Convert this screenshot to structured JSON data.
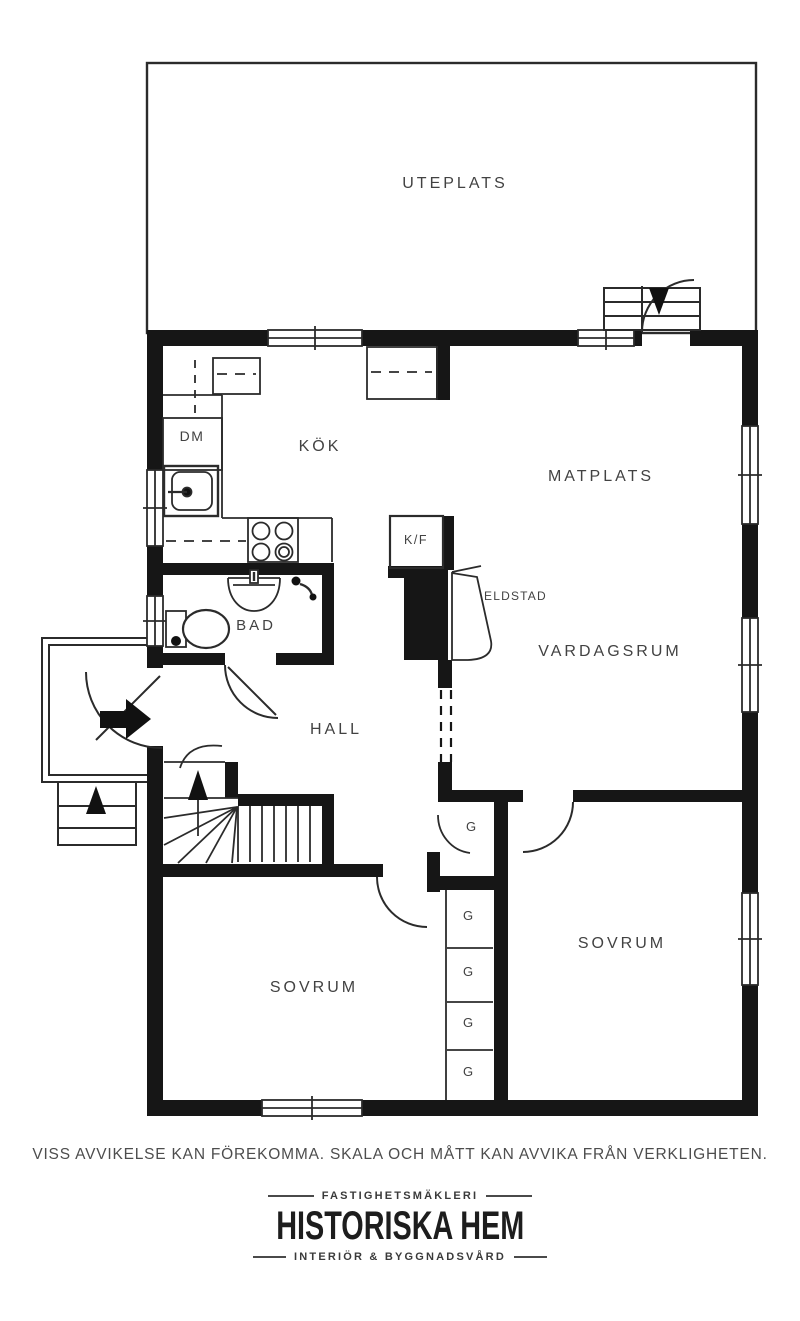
{
  "plan": {
    "rooms": {
      "uteplats": "UTEPLATS",
      "kok": "KÖK",
      "matplats": "MATPLATS",
      "vardagsrum": "VARDAGSRUM",
      "hall": "HALL",
      "bad": "BAD",
      "sovrum_left": "SOVRUM",
      "sovrum_right": "SOVRUM"
    },
    "fixtures": {
      "dm": "DM",
      "kf": "K/F",
      "eldstad": "ELDSTAD",
      "g1": "G",
      "g2": "G",
      "g3": "G",
      "g4": "G",
      "g5": "G"
    }
  },
  "footer": {
    "disclaimer": "VISS AVVIKELSE KAN FÖREKOMMA. SKALA OCH MÅTT KAN AVVIKA FRÅN VERKLIGHETEN.",
    "logo_top": "FASTIGHETSMÄKLERI",
    "logo_name": "HISTORISKA HEM",
    "logo_bottom": "INTERIÖR & BYGGNADSVÅRD"
  },
  "colors": {
    "ink": "#161616",
    "paper": "#ffffff",
    "label": "#424242"
  }
}
